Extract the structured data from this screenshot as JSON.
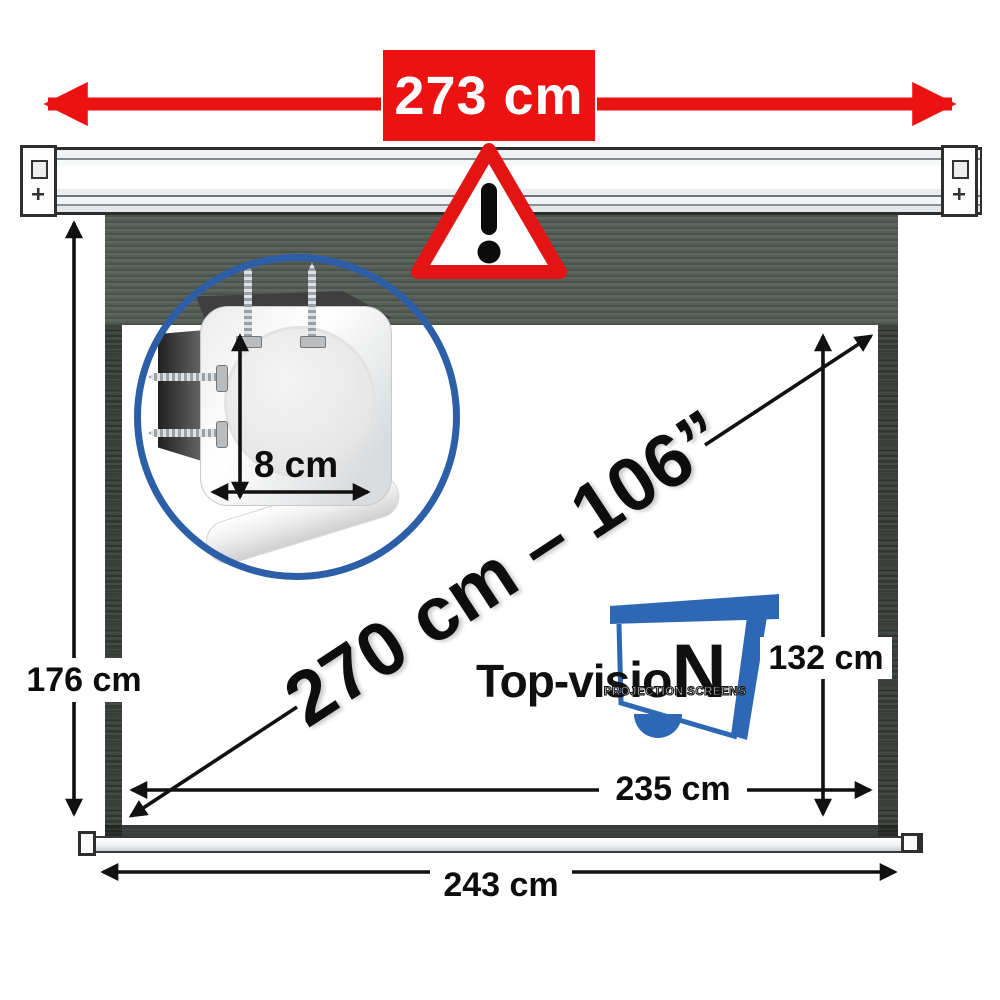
{
  "dimensions": {
    "case_width": "273 cm",
    "total_height": "176 cm",
    "viewing_height": "132 cm",
    "viewing_width": "235 cm",
    "fabric_width": "243 cm",
    "diagonal": "270 cm – 106”",
    "case_depth": "8 cm"
  },
  "logo": {
    "brand_prefix": "Top-vis",
    "brand_mid": "io",
    "brand_suffix": "N",
    "tagline": "PROJECTION SCREENS"
  },
  "icons": {
    "warning": "warning-triangle-icon",
    "case_width_arrows": "red-double-arrow",
    "mount_detail": "magnifier-circle-inset"
  },
  "colors": {
    "accent_red": "#EC1212",
    "brand_blue": "#2E68B5",
    "ring_blue": "#2D5FA8",
    "fabric_dark": "#565E58",
    "text_black": "#0D0D0D"
  }
}
